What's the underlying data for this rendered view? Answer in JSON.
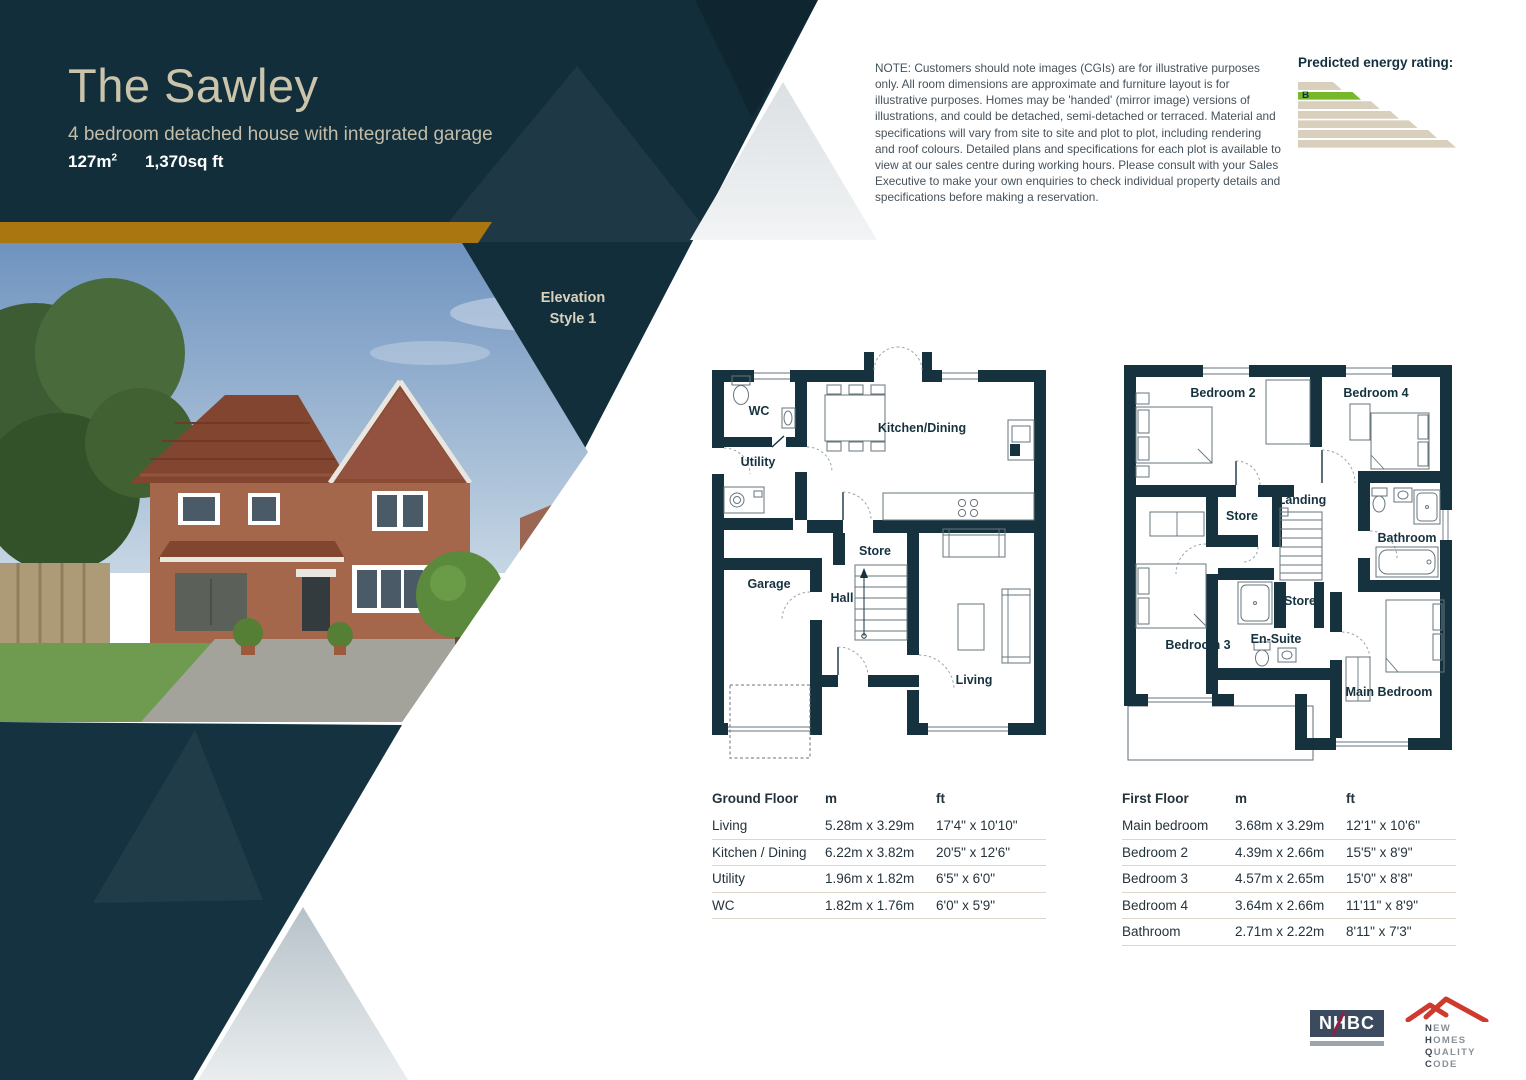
{
  "header": {
    "title": "The Sawley",
    "subtitle": "4 bedroom detached house with integrated garage",
    "area_metric": "127m",
    "area_metric_sup": "2",
    "area_imperial": "1,370sq ft"
  },
  "elevation_badge": {
    "line1": "Elevation",
    "line2": "Style 1"
  },
  "note": "NOTE: Customers should note images (CGIs) are for illustrative purposes only. All room dimensions are approximate and furniture layout is for illustrative purposes. Homes may be 'handed' (mirror image) versions of illustrations, and could be detached, semi-detached or terraced. Material and specifications will vary from site to site and plot to plot, including rendering and roof colours. Detailed plans and specifications for each plot is available to view at our sales centre during working hours. Please consult with your Sales Executive to make your own enquiries to check individual property details and specifications before making a reservation.",
  "energy": {
    "title": "Predicted energy rating:",
    "rating": "B",
    "active_index": 1,
    "bar_widths": [
      44,
      63,
      82,
      101,
      120,
      139,
      158
    ],
    "bar_color": "#d8cfbd",
    "active_color": "#76b82a"
  },
  "floorplans": {
    "ground": {
      "labels": {
        "wc": "WC",
        "utility": "Utility",
        "kitchen": "Kitchen/Dining",
        "store": "Store",
        "hall": "Hall",
        "garage": "Garage",
        "living": "Living"
      }
    },
    "first": {
      "labels": {
        "bedroom2": "Bedroom 2",
        "bedroom4": "Bedroom 4",
        "store1": "Store",
        "landing": "Landing",
        "bathroom": "Bathroom",
        "bedroom3": "Bedroom 3",
        "store2": "Store",
        "ensuite": "En-Suite",
        "main": "Main Bedroom"
      }
    }
  },
  "tables": {
    "ground": {
      "title": "Ground Floor",
      "col_m": "m",
      "col_ft": "ft",
      "rows": [
        {
          "room": "Living",
          "m": "5.28m x 3.29m",
          "ft": "17'4\" x 10'10\""
        },
        {
          "room": "Kitchen / Dining",
          "m": "6.22m x 3.82m",
          "ft": "20'5\" x 12'6\""
        },
        {
          "room": "Utility",
          "m": "1.96m x 1.82m",
          "ft": "6'5\" x 6'0\""
        },
        {
          "room": "WC",
          "m": "1.82m x 1.76m",
          "ft": "6'0\" x 5'9\""
        }
      ]
    },
    "first": {
      "title": "First Floor",
      "col_m": "m",
      "col_ft": "ft",
      "rows": [
        {
          "room": "Main bedroom",
          "m": "3.68m x 3.29m",
          "ft": "12'1\" x 10'6\""
        },
        {
          "room": "Bedroom 2",
          "m": "4.39m x 2.66m",
          "ft": "15'5\" x 8'9\""
        },
        {
          "room": "Bedroom 3",
          "m": "4.57m x 2.65m",
          "ft": "15'0\" x 8'8\""
        },
        {
          "room": "Bedroom 4",
          "m": "3.64m x 2.66m",
          "ft": "11'11\" x 8'9\""
        },
        {
          "room": "Bathroom",
          "m": "2.71m x 2.22m",
          "ft": "8'11\" x 7'3\""
        }
      ]
    }
  },
  "logos": {
    "nhbc": "NHBC",
    "nhqc_words": [
      "NEW",
      "HOMES",
      "QUALITY",
      "CODE"
    ]
  },
  "colors": {
    "navy": "#132e3b",
    "gold": "#a9760f",
    "plan_wall": "#16323f",
    "energy_green": "#76b82a"
  }
}
